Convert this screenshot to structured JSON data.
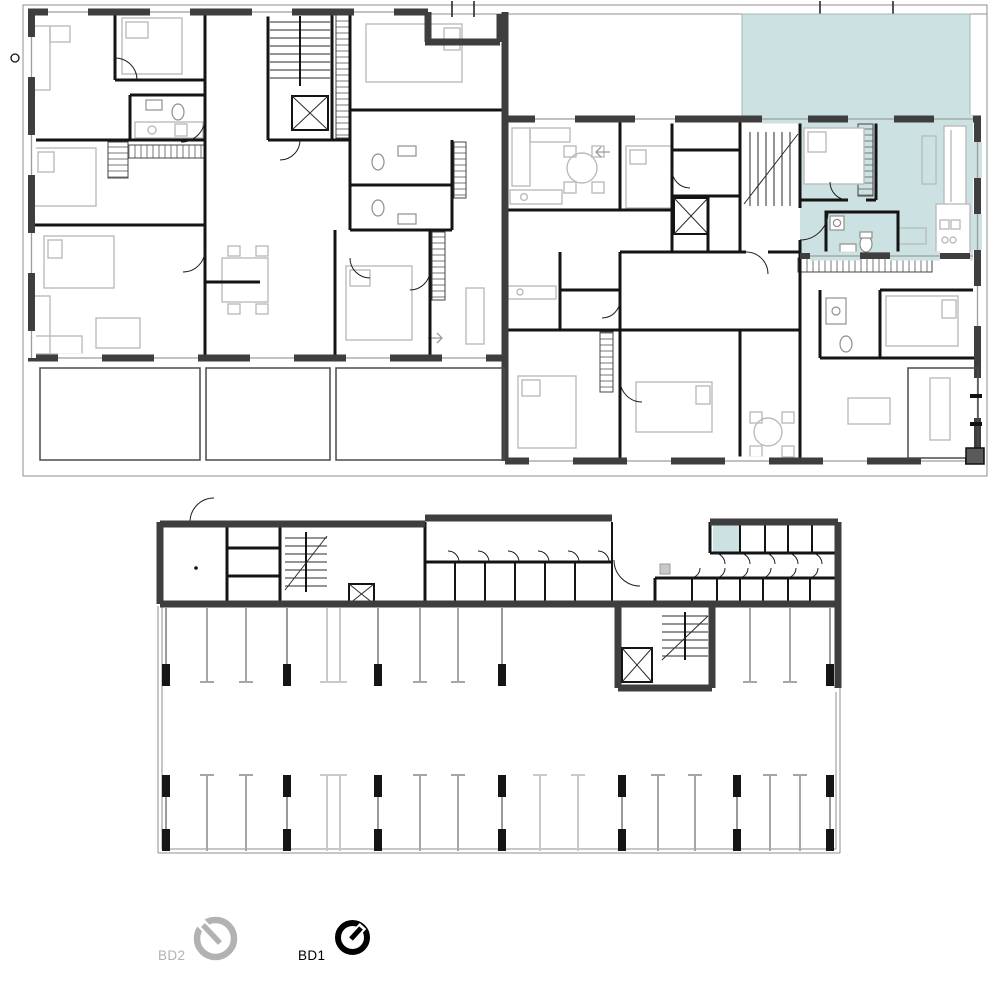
{
  "legend": {
    "items": [
      {
        "id": "bd2",
        "label": "BD2",
        "state": "inactive",
        "color": "#b2b2b2"
      },
      {
        "id": "bd1",
        "label": "BD1",
        "state": "active",
        "color": "#000000"
      }
    ]
  },
  "highlight": {
    "fill": "#cce1e2"
  },
  "palette": {
    "exterior_wall": "#3e3e3e",
    "interior_wall": "#141414",
    "furniture": "#bcbcbc",
    "parking_marking": "#a6a6a6",
    "site_line": "#8f8f8f"
  }
}
